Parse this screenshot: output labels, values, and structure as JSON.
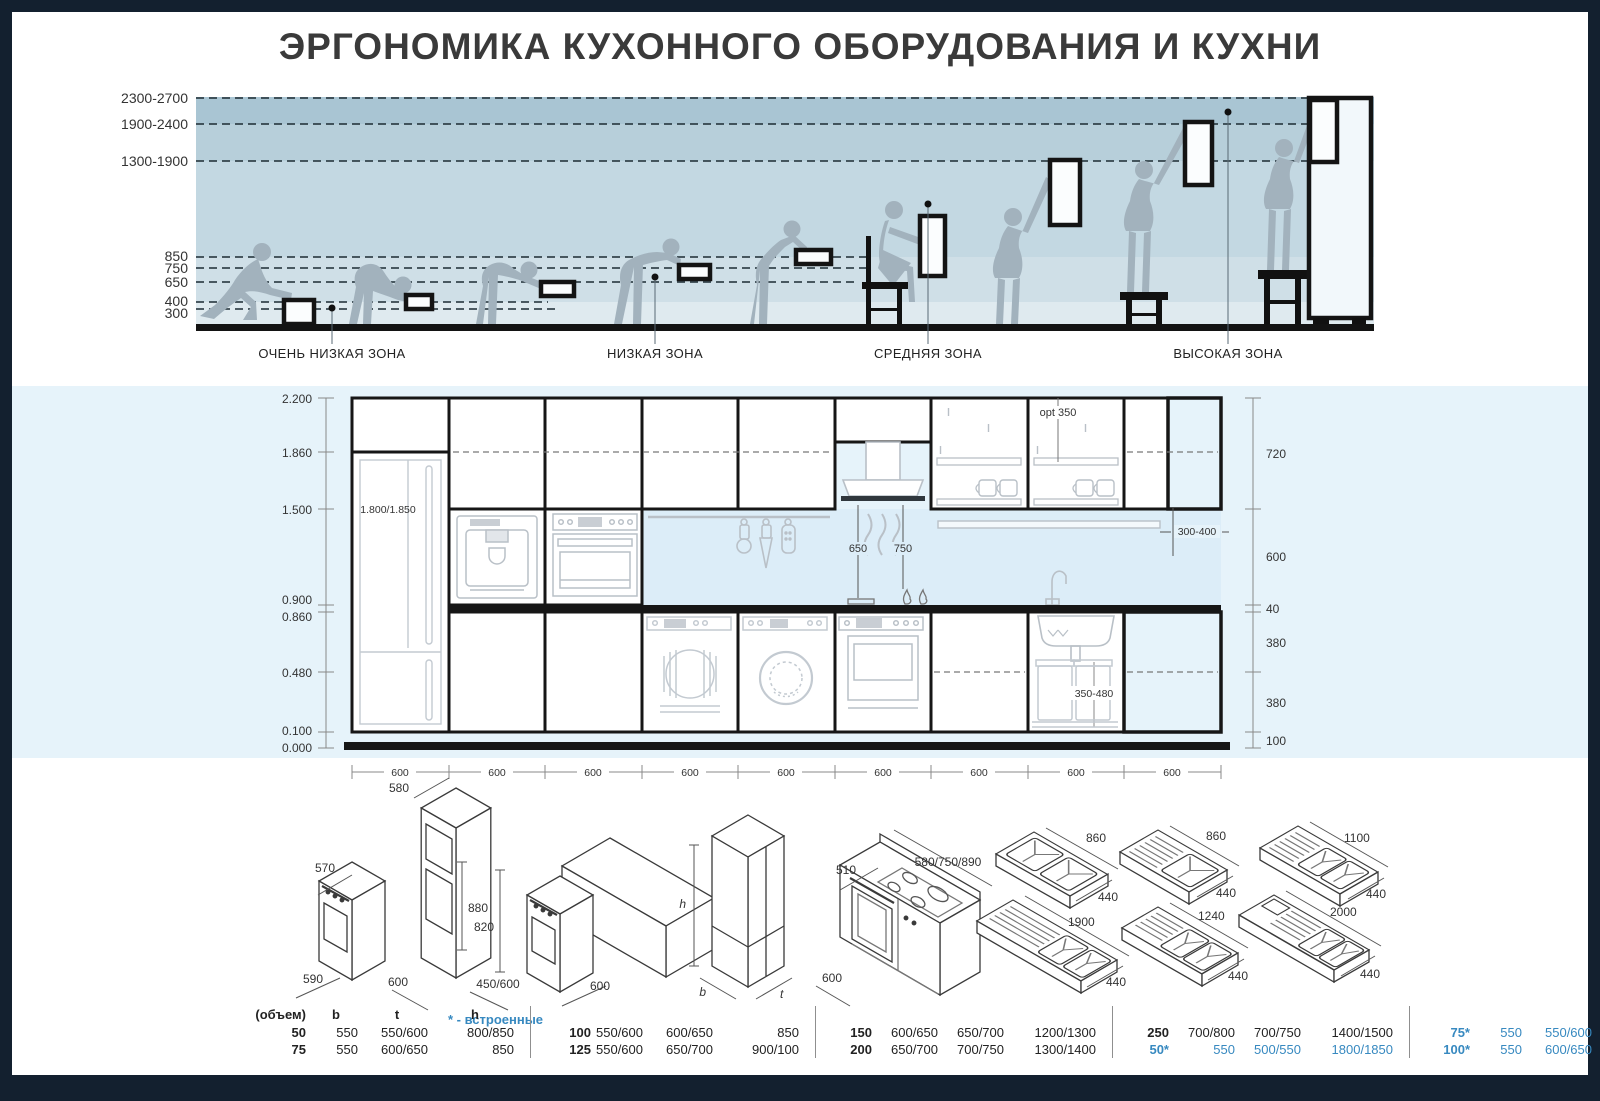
{
  "title": "ЭРГОНОМИКА КУХОННОГО ОБОРУДОВАНИЯ И КУХНИ",
  "top": {
    "heights": [
      "2300-2700",
      "1900-2400",
      "1300-1900",
      "850",
      "750",
      "650",
      "400",
      "300"
    ],
    "zones": [
      "ОЧЕНЬ НИЗКАЯ ЗОНА",
      "НИЗКАЯ ЗОНА",
      "СРЕДНЯЯ ЗОНА",
      "ВЫСОКАЯ ЗОНА"
    ]
  },
  "elevation": {
    "left_scale": [
      "2.200",
      "1.860",
      "1.500",
      "0.900",
      "0.860",
      "0.480",
      "0.100",
      "0.000"
    ],
    "right_scale": [
      "720",
      "600",
      "40",
      "380",
      "380",
      "100"
    ],
    "fridge_label": "1.800/1.850",
    "opt_label": "opt 350",
    "hood_electric": "650",
    "hood_gas": "750",
    "shelf_depth": "300-400",
    "bin_width": "350-480",
    "bottom_dims": [
      "600",
      "600",
      "600",
      "600",
      "600",
      "600",
      "600",
      "600",
      "600"
    ]
  },
  "iso": {
    "oven_column": {
      "top": "580",
      "oven_depth": "570",
      "niche_height": "880",
      "oven_width": "590",
      "cabinet_width": "600"
    },
    "under_counter": {
      "height": "820",
      "oven_width": "450/600",
      "cabinet_width": "600"
    },
    "fridge": {
      "height": "h",
      "width": "b",
      "depth": "t"
    },
    "range": {
      "cooktop_depth": "510",
      "cooktop_widths": "580/750/890",
      "oven_width": "600"
    },
    "sinks": [
      {
        "w": "860",
        "d": "440"
      },
      {
        "w": "860",
        "d": "440"
      },
      {
        "w": "1100",
        "d": "440"
      },
      {
        "w": "1900",
        "d": "440"
      },
      {
        "w": "1240",
        "d": "440"
      },
      {
        "w": "2000",
        "d": "440"
      }
    ]
  },
  "table": {
    "header": {
      "vol": "(объем)",
      "b": "b",
      "t": "t",
      "h": "h"
    },
    "note": "* - встроенные",
    "groups": [
      {
        "rows": [
          {
            "vol": "50",
            "b": "550",
            "t": "550/600",
            "h": "800/850"
          },
          {
            "vol": "75",
            "b": "550",
            "t": "600/650",
            "h": "850"
          }
        ]
      },
      {
        "rows": [
          {
            "vol": "100",
            "b": "550/600",
            "t": "600/650",
            "h": "850"
          },
          {
            "vol": "125",
            "b": "550/600",
            "t": "650/700",
            "h": "900/100"
          }
        ]
      },
      {
        "rows": [
          {
            "vol": "150",
            "b": "600/650",
            "t": "650/700",
            "h": "1200/1300"
          },
          {
            "vol": "200",
            "b": "650/700",
            "t": "700/750",
            "h": "1300/1400"
          }
        ]
      },
      {
        "rows": [
          {
            "vol": "250",
            "b": "700/800",
            "t": "700/750",
            "h": "1400/1500"
          },
          {
            "vol": "50*",
            "b": "550",
            "t": "500/550",
            "h": "1800/1850"
          }
        ]
      },
      {
        "rows": [
          {
            "vol": "75*",
            "b": "550",
            "t": "550/600",
            "h": "850/900"
          },
          {
            "vol": "100*",
            "b": "550",
            "t": "600/650",
            "h": "900"
          }
        ]
      }
    ]
  },
  "colors": {
    "frame": "#13202f",
    "accent_blue": "#3789c0",
    "band_blue": "#e6f3fa",
    "backsplash": "#dcedf8",
    "silhouette": "#a2b2bd",
    "ink": "#161616",
    "zone_top": "#a9c5d3",
    "zone_mid": "#c3d8e2"
  }
}
